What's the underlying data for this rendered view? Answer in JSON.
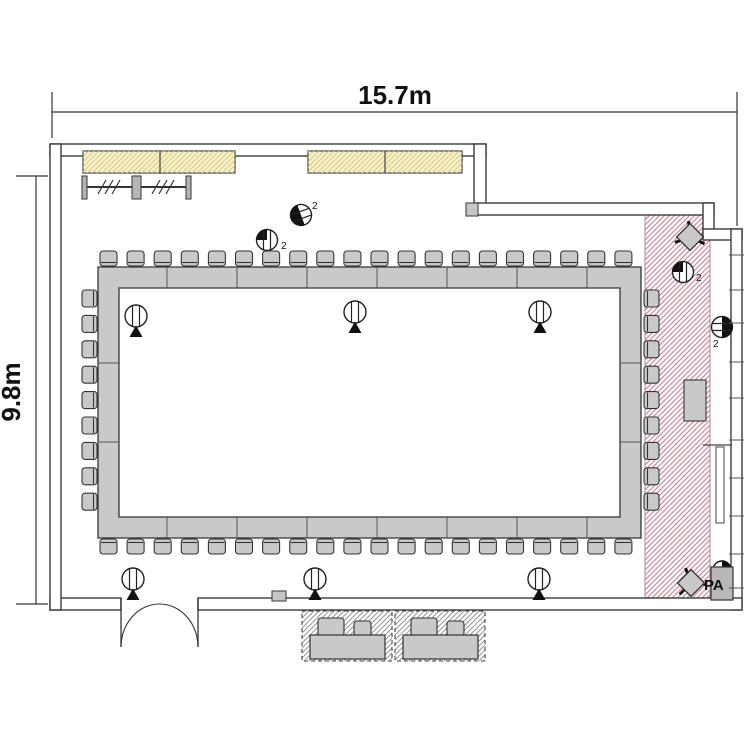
{
  "dimensions": {
    "width": "15.7m",
    "height": "9.8m"
  },
  "labels": {
    "pa": "PA",
    "count_suffix": "2"
  },
  "colors": {
    "wall": "#3c3c3c",
    "furniture_fill": "#c9c9c9",
    "furniture_stroke": "#333333",
    "pink_hatch": "#d18e9d",
    "yellow_fill": "#f7f2cb",
    "yellow_hatch": "#d9ca85",
    "gray_hatch": "#9b9b9b",
    "text": "#111111"
  },
  "floor_plan": {
    "canvas": {
      "w": 750,
      "h": 750
    },
    "walls": [
      {
        "x": 50,
        "y": 144,
        "w": 436,
        "h": 12
      },
      {
        "x": 474,
        "y": 144,
        "w": 12,
        "h": 70
      },
      {
        "x": 474,
        "y": 203,
        "w": 240,
        "h": 12
      },
      {
        "x": 703,
        "y": 203,
        "w": 11,
        "h": 36
      },
      {
        "x": 703,
        "y": 229,
        "w": 39,
        "h": 11
      },
      {
        "x": 731,
        "y": 229,
        "w": 11,
        "h": 381
      },
      {
        "x": 50,
        "y": 598,
        "w": 71,
        "h": 12
      },
      {
        "x": 198,
        "y": 598,
        "w": 544,
        "h": 12
      },
      {
        "x": 50,
        "y": 144,
        "w": 11,
        "h": 466
      }
    ],
    "door": {
      "jamb_left_x": 121,
      "jamb_right_x": 198,
      "top_y": 598,
      "bottom_y": 647,
      "peak": [
        159.5,
        604
      ]
    },
    "windows": [
      {
        "x": 83,
        "y": 151,
        "w": 152,
        "h": 22,
        "divider_x": 160
      },
      {
        "x": 308,
        "y": 151,
        "w": 154,
        "h": 22,
        "divider_x": 385
      }
    ],
    "coat_rack": {
      "rail": {
        "x1": 82,
        "y": 187,
        "x2": 191
      },
      "posts": [
        {
          "x": 82,
          "w": 5
        },
        {
          "x": 132,
          "w": 9
        },
        {
          "x": 186,
          "w": 5
        }
      ],
      "post_y": 176,
      "post_h": 23,
      "slash_groups": [
        98,
        152
      ]
    },
    "hatch_zone": {
      "x": 645,
      "y": 215,
      "w": 65,
      "h": 383
    },
    "table": {
      "outer": {
        "x": 98,
        "y": 267,
        "w": 543,
        "h": 271
      },
      "inner": {
        "x": 119,
        "y": 288,
        "w": 501,
        "h": 229
      },
      "dividers_x": [
        167,
        237,
        307,
        377,
        447,
        517,
        587
      ],
      "dividers_y": [
        363,
        442
      ]
    },
    "chairs": {
      "top": {
        "count": 20,
        "x0": 100,
        "y": 251,
        "pitch": 27.1,
        "w": 17,
        "h": 15,
        "side": "top"
      },
      "bottom": {
        "count": 20,
        "x0": 100,
        "y": 539,
        "pitch": 27.1,
        "w": 17,
        "h": 15,
        "side": "bottom"
      },
      "left": {
        "count": 9,
        "x": 82,
        "y0": 290,
        "pitch": 25.4,
        "w": 15,
        "h": 17,
        "side": "left"
      },
      "right": {
        "count": 9,
        "x": 644,
        "y0": 290,
        "pitch": 25.4,
        "w": 15,
        "h": 17,
        "side": "right"
      }
    },
    "speakers": [
      [
        136,
        316
      ],
      [
        355,
        312
      ],
      [
        540,
        312
      ],
      [
        133,
        579
      ],
      [
        315,
        579
      ],
      [
        539,
        579
      ]
    ],
    "outlets": [
      {
        "cx": 301,
        "cy": 215,
        "variant": "half",
        "side": "left",
        "rot": -20,
        "tx": 312,
        "ty": 209
      },
      {
        "cx": 267,
        "cy": 240,
        "variant": "quarter",
        "rot": 0,
        "tx": 281,
        "ty": 249
      },
      {
        "cx": 683,
        "cy": 272,
        "variant": "quarter",
        "rot": 0,
        "tx": 696,
        "ty": 281
      },
      {
        "cx": 722,
        "cy": 327,
        "variant": "half",
        "side": "right",
        "rot": 0,
        "tx": 713,
        "ty": 347
      }
    ],
    "stack_chairs": [
      {
        "cx": 690,
        "cy": 237,
        "legs": [
          25,
          160,
          265
        ]
      },
      {
        "cx": 691,
        "cy": 583,
        "legs": [
          5,
          135,
          250
        ]
      }
    ],
    "equipment": {
      "x": 684,
      "y": 380,
      "w": 22,
      "h": 41
    },
    "pa_unit": {
      "box": {
        "x": 711,
        "y": 567,
        "w": 22,
        "h": 33
      },
      "circle": {
        "cx": 722,
        "cy": 570,
        "r": 9
      },
      "text_x": 704,
      "text_y": 590
    },
    "wall_boxes": [
      {
        "x": 466,
        "y": 203,
        "w": 12,
        "h": 13
      },
      {
        "x": 272,
        "y": 591,
        "w": 14,
        "h": 10
      }
    ],
    "right_fixture": {
      "line_y": 445,
      "rect": {
        "x": 716,
        "y": 447,
        "w": 8,
        "h": 76
      }
    },
    "right_wall_ticks": [
      255,
      290,
      323,
      362,
      398,
      440,
      478,
      516,
      554,
      588
    ],
    "bench_units": [
      {
        "x": 302,
        "y": 611
      },
      {
        "x": 395,
        "y": 611
      }
    ],
    "bench_geom": {
      "w": 90,
      "h": 50,
      "seat": {
        "dx": 8,
        "dy": 24,
        "w": 75,
        "h": 24
      },
      "chair1": {
        "dx": 16,
        "dy": 7,
        "w": 26,
        "h": 18
      },
      "chair2": {
        "dx": 52,
        "dy": 10,
        "w": 17,
        "h": 15
      }
    },
    "dim_top": {
      "line_y": 112,
      "x1": 52,
      "x2": 737,
      "ext_left": [
        52,
        92,
        138
      ],
      "ext_right": [
        737,
        92,
        226
      ],
      "text_x": 395,
      "text_y": 104
    },
    "dim_left": {
      "line_x": 36,
      "y1": 176,
      "y2": 604,
      "tick_x1": 16,
      "tick_x2": 48,
      "text_x": 20,
      "text_y": 392
    }
  }
}
